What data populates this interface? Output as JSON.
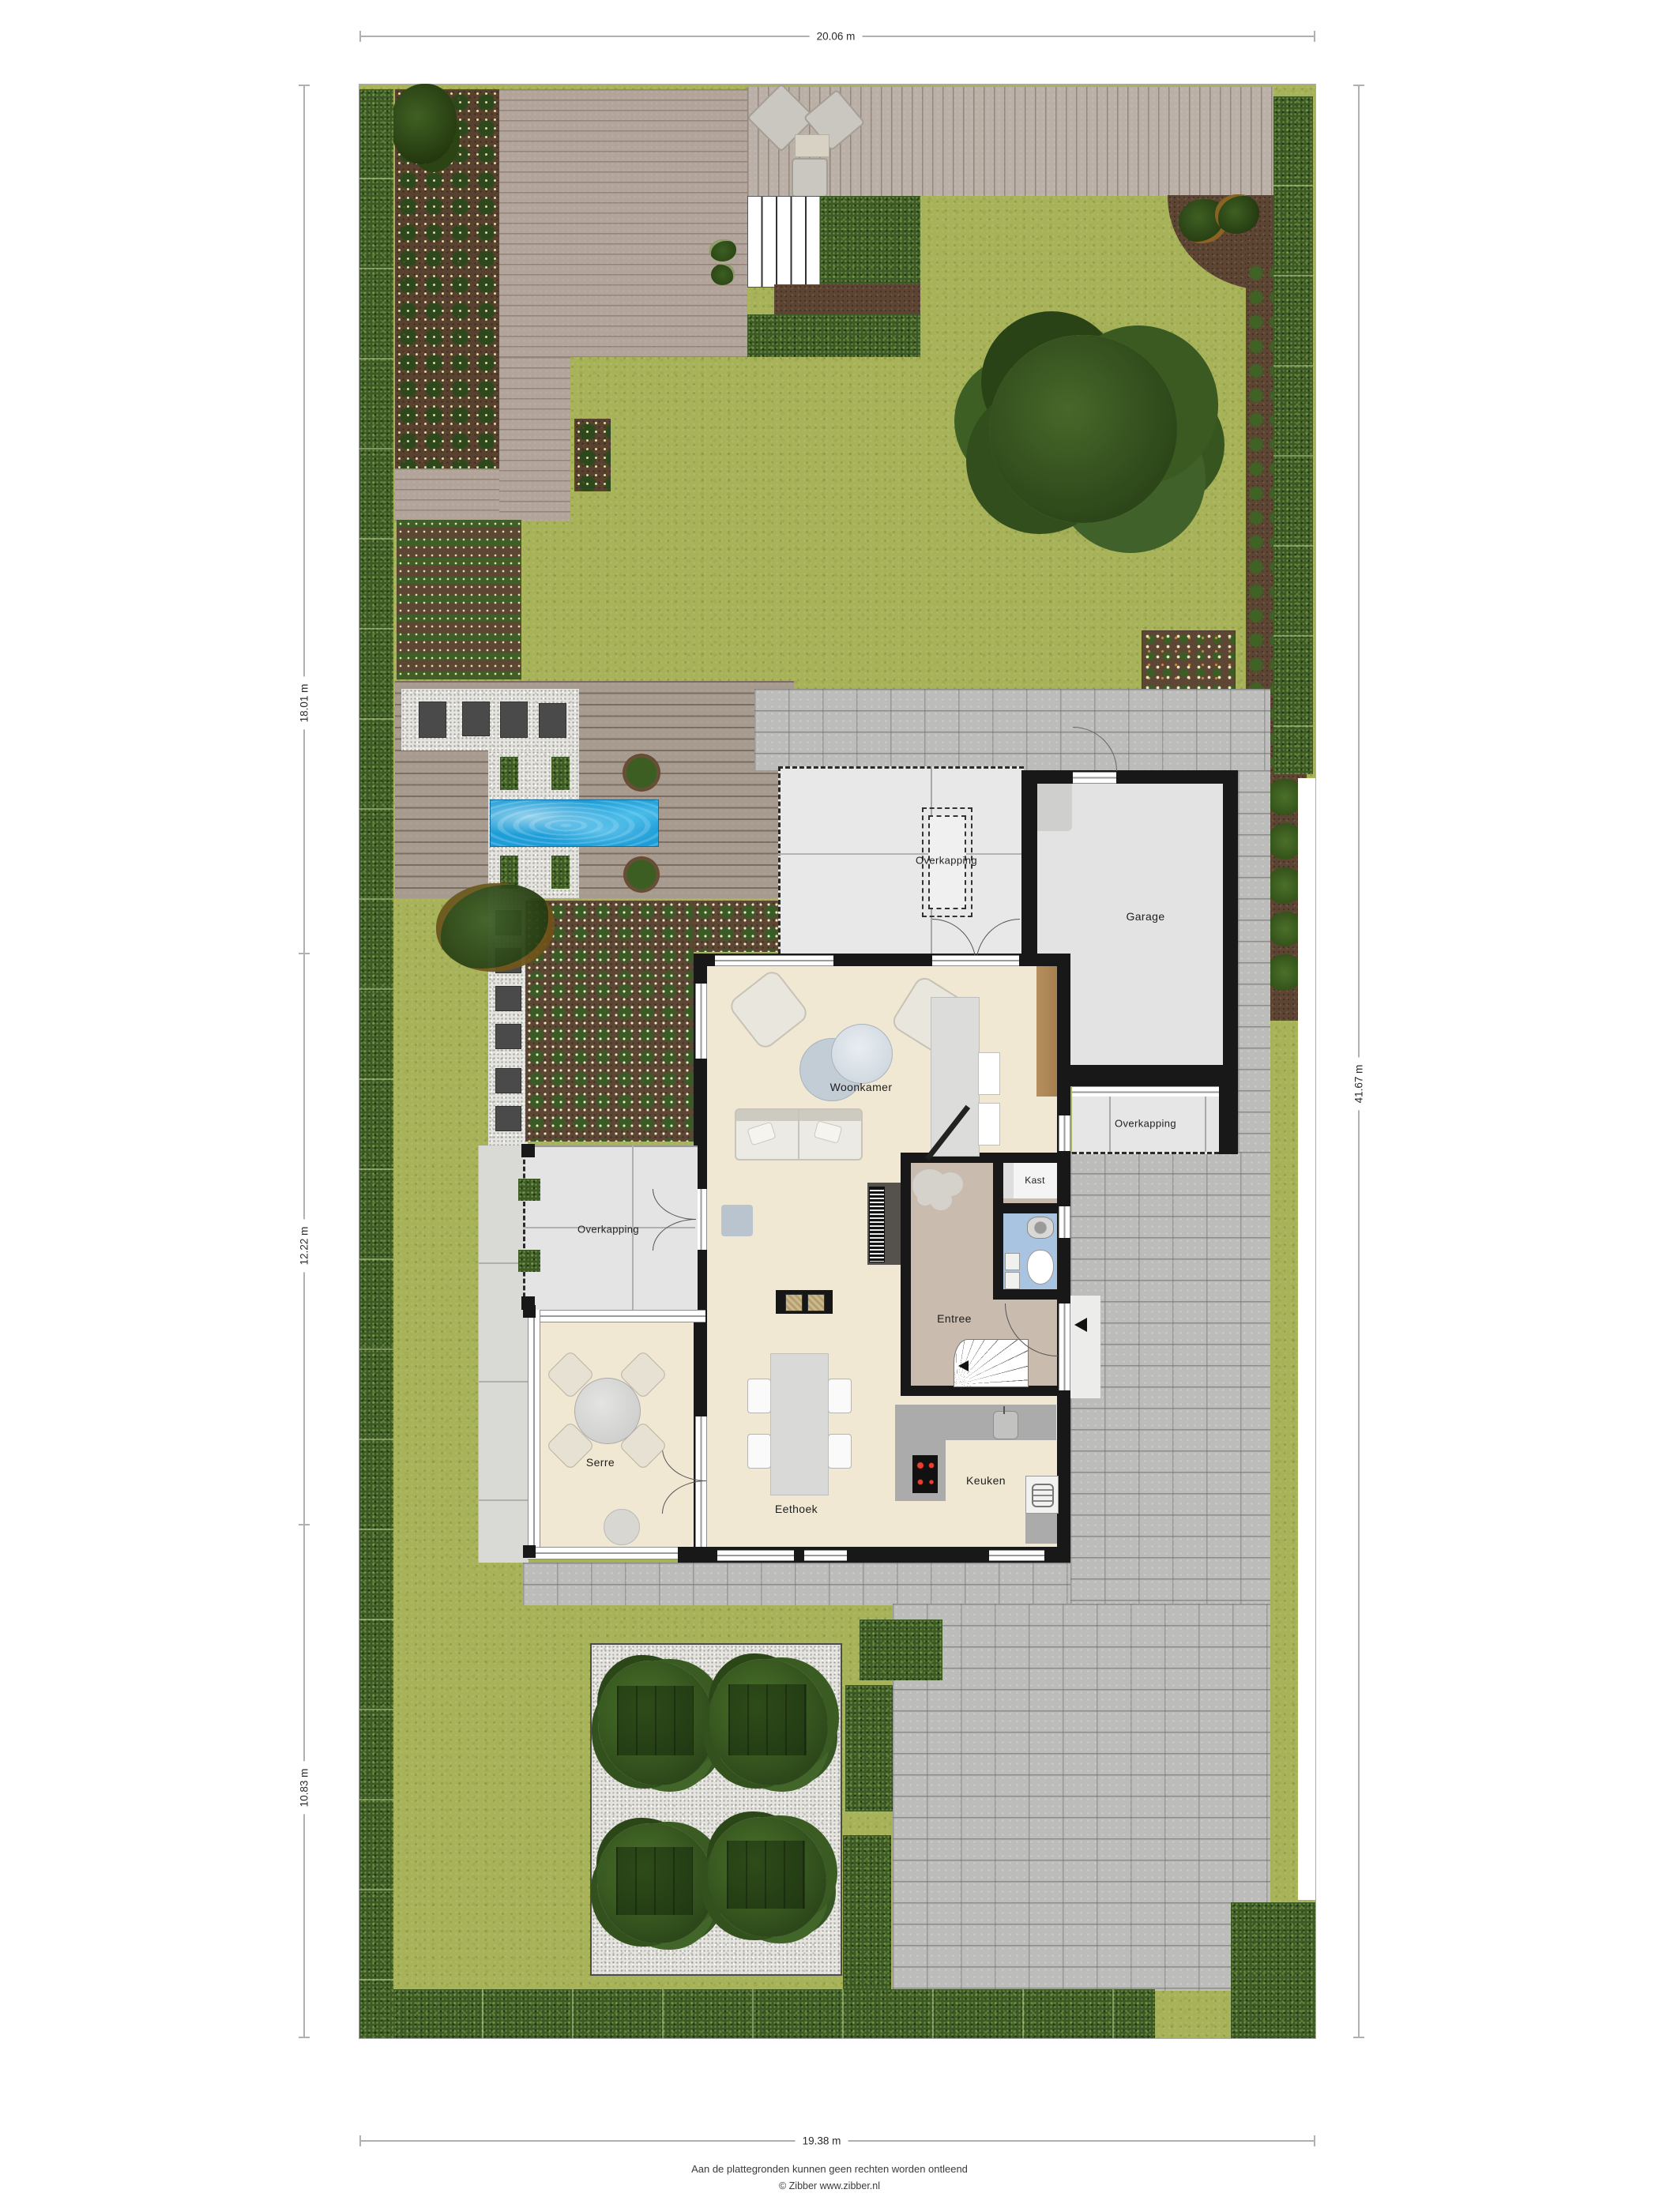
{
  "plan_dimensions": {
    "top": "20.06 m",
    "left_top": "18.01 m",
    "left_middle": "12.22 m",
    "left_bottom": "10.83 m",
    "right": "41.67 m",
    "bottom": "19.38 m"
  },
  "rooms": {
    "woonkamer": "Woonkamer",
    "eethoek": "Eethoek",
    "keuken": "Keuken",
    "entree": "Entree",
    "kast": "Kast",
    "serre": "Serre",
    "garage": "Garage",
    "overkapping_west": "Overkapping",
    "overkapping_carport": "Overkapping",
    "overkapping_garage": "Overkapping"
  },
  "footer": {
    "disclaimer": "Aan de plattegronden kunnen geen rechten worden ontleend",
    "credit": "© Zibber www.zibber.nl"
  },
  "colors": {
    "lawn": "#a8b259",
    "hedge": "#3c5a24",
    "deck_wood": "#b2a49a",
    "pool_water": "#1d9ed8",
    "paving": "#bcbcba",
    "gravel": "#e5e4df",
    "soil": "#5e4533",
    "floor_living": "#f0e8d2",
    "floor_entree": "#c9bcae",
    "floor_toilet": "#a9c4e0",
    "floor_garage": "#e3e3e3",
    "wall": "#181818"
  }
}
